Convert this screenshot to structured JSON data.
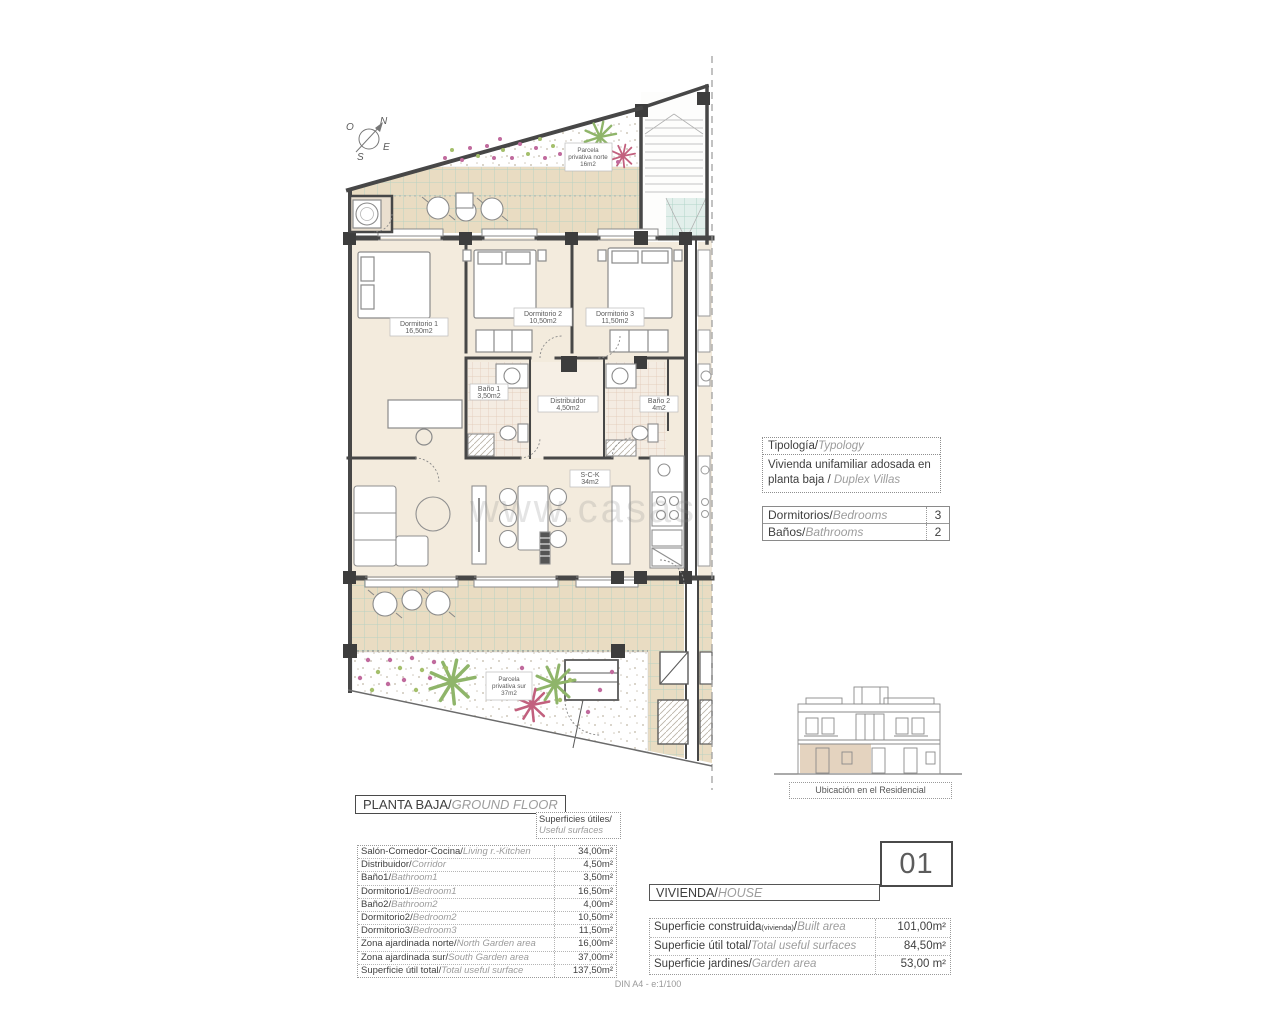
{
  "page": {
    "footer_note": "DIN A4 - e:1/100",
    "watermark": "www.casas"
  },
  "colors": {
    "floor_beige": "#f3ebdd",
    "tile_tan": "#e9dcc2",
    "tile_line_teal": "#a9cec1",
    "bath_tile_line": "#dcc0ab",
    "palm_green": "#8fb56a",
    "palm_red": "#c2607e",
    "elevation_highlight": "#e4d3bf",
    "wall": "#474747"
  },
  "compass": {
    "n": "N",
    "s": "S",
    "e": "E",
    "o": "O"
  },
  "plan": {
    "rooms": {
      "dormitorio1": {
        "name": "Dormitorio 1",
        "area": "16,50m2"
      },
      "dormitorio2": {
        "name": "Dormitorio 2",
        "area": "10,50m2"
      },
      "dormitorio3": {
        "name": "Dormitorio 3",
        "area": "11,50m2"
      },
      "bano1": {
        "name": "Baño 1",
        "area": "3,50m2"
      },
      "bano2": {
        "name": "Baño 2",
        "area": "4m2"
      },
      "distribuidor": {
        "name": "Distribuidor",
        "area": "4,50m2"
      },
      "sck": {
        "name": "S-C-K",
        "area": "34m2"
      },
      "parcela_norte": {
        "line1": "Parcela",
        "line2": "privativa norte",
        "line3": "16m2"
      },
      "parcela_sur": {
        "line1": "Parcela",
        "line2": "privativa sur",
        "line3": "37m2"
      }
    }
  },
  "typology": {
    "label_es": "Tipología/",
    "label_en": "Typology",
    "value_es": "Vivienda unifamiliar adosada en planta baja / ",
    "value_en": "Duplex Villas"
  },
  "rooms_table": {
    "rows": [
      {
        "es": "Dormitorios/",
        "en": "Bedrooms",
        "value": "3"
      },
      {
        "es": "Baños/",
        "en": "Bathrooms",
        "value": "2"
      }
    ]
  },
  "location": {
    "caption": "Ubicación en el Residencial"
  },
  "ground_floor": {
    "title_es": "PLANTA BAJA/",
    "title_en": "GROUND FLOOR",
    "header_es": "Superficies útiles/",
    "header_en": "Useful surfaces",
    "rows": [
      {
        "es": "Salón-Comedor-Cocina/",
        "en": "Living r.-Kitchen",
        "value": "34,00m²"
      },
      {
        "es": "Distribuidor/",
        "en": "Corridor",
        "value": "4,50m²"
      },
      {
        "es": "Baño1/",
        "en": "Bathroom1",
        "value": "3,50m²"
      },
      {
        "es": "Dormitorio1/",
        "en": "Bedroom1",
        "value": "16,50m²"
      },
      {
        "es": "Baño2/",
        "en": "Bathroom2",
        "value": "4,00m²"
      },
      {
        "es": "Dormitorio2/",
        "en": "Bedroom2",
        "value": "10,50m²"
      },
      {
        "es": "Dormitorio3/",
        "en": "Bedroom3",
        "value": "11,50m²"
      },
      {
        "es": "Zona ajardinada norte/",
        "en": "North Garden area",
        "value": "16,00m²"
      },
      {
        "es": "Zona ajardinada sur/",
        "en": "South Garden area",
        "value": "37,00m²"
      },
      {
        "es": "Superficie útil total/",
        "en": "Total useful surface",
        "value": "137,50m²"
      }
    ]
  },
  "house": {
    "unit_number": "01",
    "label_es": "VIVIENDA/",
    "label_en": "HOUSE",
    "rows": [
      {
        "es": "Superficie construida",
        "sub": "(vivienda)",
        "sl": "/",
        "en": "Built area",
        "value": "101,00m²"
      },
      {
        "es": "Superficie útil total/",
        "sub": "",
        "sl": "",
        "en": "Total useful surfaces",
        "value": "84,50m²"
      },
      {
        "es": "Superficie jardines/",
        "sub": "",
        "sl": "",
        "en": "Garden area",
        "value": "53,00 m²"
      }
    ]
  }
}
